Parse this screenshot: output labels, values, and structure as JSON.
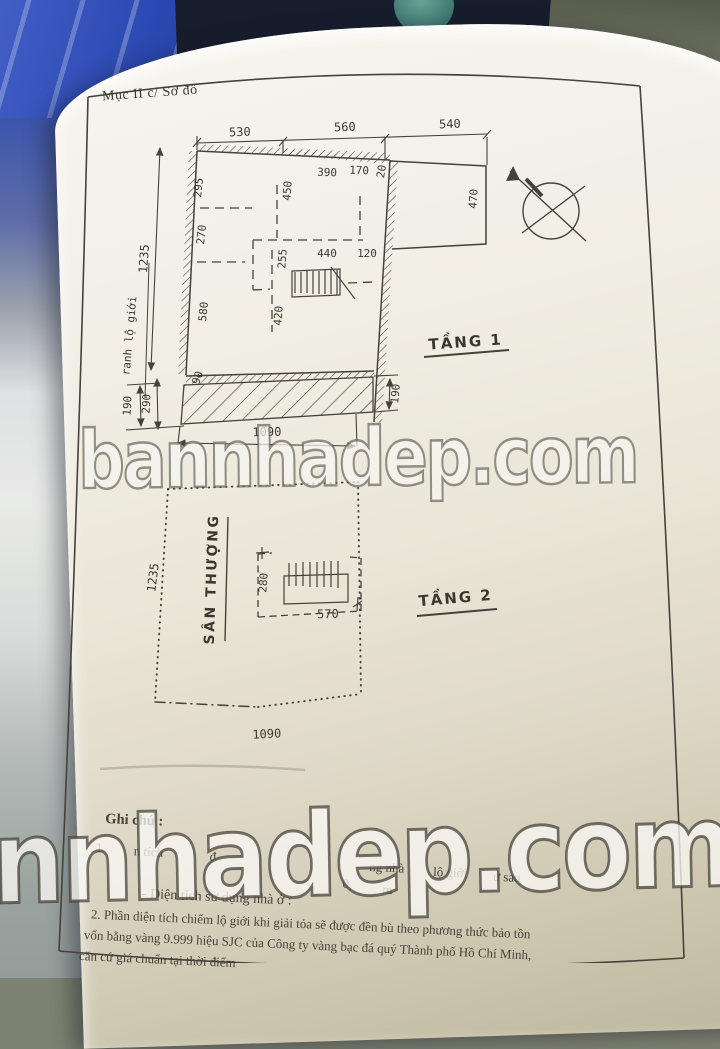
{
  "watermarks": {
    "middle": "bannhadep.com",
    "bottom": "nnhadep.com"
  },
  "page": {
    "header": "Mục II c/ Sơ đồ",
    "floor1": {
      "title": "TẦNG 1",
      "dim_top_1": "530",
      "dim_top_2": "560",
      "dim_top_3": "540",
      "dim_left_total": "1235",
      "boundary_label": "ranh lộ giới",
      "dim_wall_1": "295",
      "dim_wall_2": "270",
      "dim_wall_3": "580",
      "dim_wall_4": "90",
      "dim_inner_450": "450",
      "dim_inner_255": "255",
      "dim_inner_420": "420",
      "dim_inner_440": "440",
      "dim_inner_120": "120",
      "dim_top_inner_390": "390",
      "dim_top_inner_170": "170",
      "dim_top_inner_20": "20",
      "dim_ext_470": "470",
      "dim_bottom_left_190": "190",
      "dim_bottom_left_290": "290",
      "dim_bottom_right_190": "190",
      "dim_bottom_total": "1090"
    },
    "floor2": {
      "title": "TẦNG 2",
      "terrace_label": "SÂN THƯỢNG",
      "dim_left_total": "1235",
      "dim_stair_width": "280",
      "dim_stair_length": "570",
      "dim_bottom_total": "1090"
    },
    "notes": {
      "heading": "Ghi chú :",
      "item1_no": "1.",
      "item1_frag_1": "n tích",
      "item1_frag_2": "đ",
      "item1_frag_3": "ng nhà",
      "item1_frag_4": "lộ giới",
      "item1_frag_5": "ư sau",
      "item1_frag_6": "0,",
      "item1_frag_7": "m",
      "usage_line": "- Diện tích sử dụng nhà ở :",
      "item2_line1": "2. Phần diện tích chiếm lộ giới khi giải tỏa sẽ được đền bù theo phương thức bảo tồn",
      "item2_line2": "vốn bằng vàng 9.999 hiệu SJC của Công ty vàng bạc đá quý Thành phố Hồ Chí Minh,",
      "item2_line3": "căn cứ giá chuẩn tại thời điểm"
    }
  }
}
